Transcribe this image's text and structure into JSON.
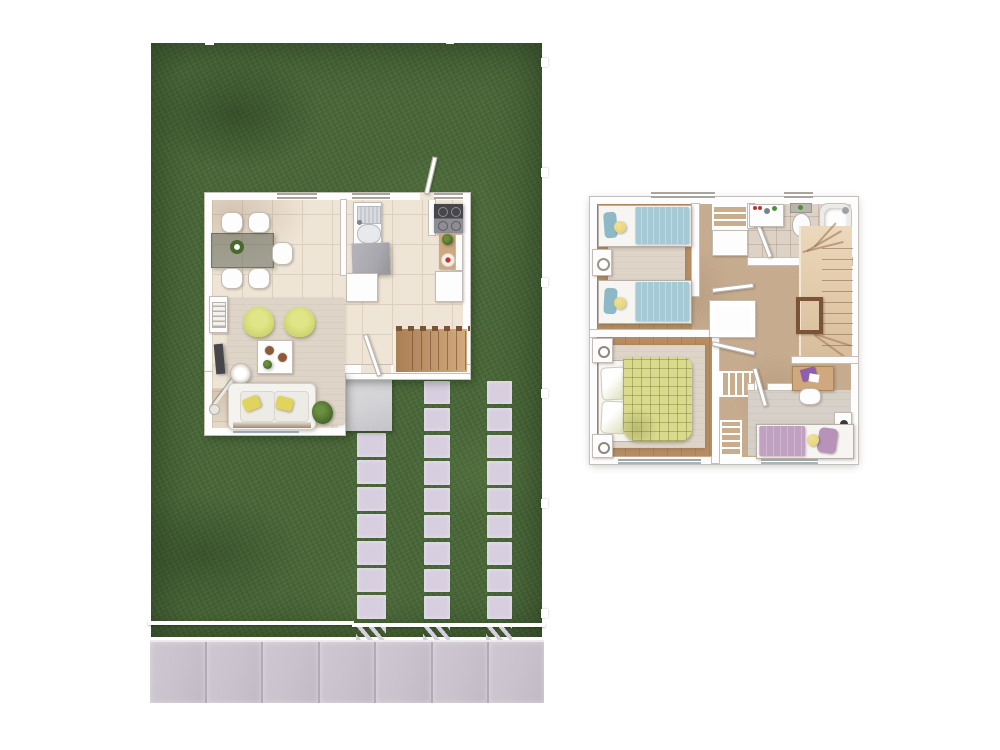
{
  "scene": {
    "type": "architectural-floor-plans",
    "description": "Top-down render of a two-storey house: ground floor inside a grass lot with paver walkways and street sidewalk (left), upper floor plan (right). No visible text labels.",
    "background": "#ffffff"
  },
  "palette": {
    "grass": "#4a6839",
    "grass-dark": "#3a5530",
    "grass-light": "#5e7d48",
    "paver": "#d7cfdf",
    "sidewalk": "#c9c2cc",
    "joint": "#b2abb6",
    "wall": "#fdfdfd",
    "wall-line": "#c6bfb7",
    "tile": "#efe5d7",
    "tile-line": "#ddd0bd",
    "carpet": "#c5aa8d",
    "rug": "#ded4c7",
    "wood-trim": "#b58c63",
    "stair-gf": "#bc9066",
    "stair-uf": "#e2cbab",
    "rail-dark": "#7c5435",
    "sofa-white": "#f5f3ef",
    "chair-yellow": "#cfd66f",
    "pillow-yellow": "#e0d45e",
    "bed-blue": "#a5cad6",
    "pillow-blue": "#8fb8c6",
    "bed-green": "#d9da8b",
    "pillow-green": "#d9ddb6",
    "bed-purple": "#c0a1c2",
    "pillow-purple": "#b793ba",
    "cushion-yellow": "#e5cf6a",
    "glass-table": "rgba(96,102,88,0.55)",
    "appliance-dark": "#46464b",
    "appliance-mid": "#8d8d93",
    "island-gray": "#a8a8ae",
    "wood-counter": "#cfa87d",
    "desk-wood": "#cfa87d",
    "laptop-purple": "#8f5fae",
    "plant": "#49682e",
    "entry-pad": "#d3d3d6",
    "window-frame": "#a9a49e",
    "window-glass": "#9fb7c2",
    "bath-tile": "#dcd2c6"
  },
  "ground_floor": {
    "lot": {
      "fence_color": "#ffffff",
      "paver_columns": [
        {
          "id": "path-a",
          "pavers": 7
        },
        {
          "id": "path-b",
          "pavers": 9
        },
        {
          "id": "path-c",
          "pavers": 9
        }
      ],
      "sidewalk_slabs": 7,
      "fence_posts_right": 6
    },
    "rooms": [
      "dining-area",
      "kitchen",
      "living-room",
      "stair-hall"
    ],
    "furniture": [
      "dining-table",
      "dining-chairs-x5",
      "centerpiece-plant",
      "kitchen-sink",
      "kitchen-island",
      "stove",
      "counter-with-fruit",
      "fridge",
      "phone-table",
      "tv",
      "armchair-x2",
      "coffee-table",
      "arc-lamp",
      "sofa",
      "floor-plant",
      "staircase",
      "entry-pad"
    ],
    "stair_treads": 7
  },
  "upper_floor": {
    "rooms": [
      "twin-bedroom",
      "bathroom",
      "master-bedroom",
      "kids-bedroom",
      "hallway",
      "stairwell"
    ],
    "furniture": [
      "twin-bed-x2",
      "nightstand-x4",
      "wardrobe",
      "closet-rods-x3",
      "linen-closet",
      "bathroom-vanity",
      "toilet",
      "bathtub",
      "double-bed-plaid",
      "single-bed-purple",
      "desk-with-laptop",
      "desk-chair",
      "staircase-upper"
    ],
    "stair_treads": 10
  },
  "generate": {
    "repeat": [
      {
        "container": "path-a",
        "item_class": "paver",
        "count": 7
      },
      {
        "container": "path-b",
        "item_class": "paver",
        "count": 9
      },
      {
        "container": "path-c",
        "item_class": "paver",
        "count": 9
      },
      {
        "container": "sidewalk-slabs",
        "item_class": "slab",
        "count": 7
      },
      {
        "container": "gf-stair-treads",
        "item_class": "gf-tread",
        "count": 7
      },
      {
        "container": "uf-stair-treads",
        "item_class": "uf-tread",
        "count": 10
      },
      {
        "container": "fence-posts-right",
        "item_class": "fence-post",
        "count": 6
      }
    ]
  }
}
